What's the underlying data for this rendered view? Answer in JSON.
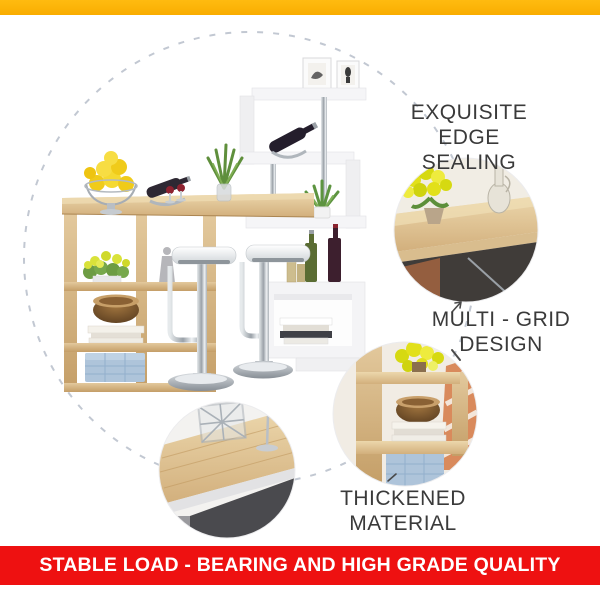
{
  "top_bar": {
    "color": "#f9ad00"
  },
  "callouts": {
    "edge_sealing": {
      "line1": "EXQUISITE",
      "line2": "EDGE SEALING"
    },
    "multi_grid": {
      "line1": "MULTI - GRID",
      "line2": "DESIGN"
    },
    "thickened": {
      "text": "THICKENED MATERIAL"
    }
  },
  "banner": {
    "text": "STABLE LOAD - BEARING AND HIGH GRADE QUALITY",
    "bg_color": "#ee1111",
    "text_color": "#ffffff"
  },
  "colors": {
    "accent_yellow": "#f9ad00",
    "accent_red": "#ee1111",
    "callout_text": "#3a3a3a",
    "dashed_circle": "#c2c8d2",
    "wood": "#cfa973",
    "shelf_white": "#f5f5f6",
    "storage_box_blue": "#aec4da"
  }
}
